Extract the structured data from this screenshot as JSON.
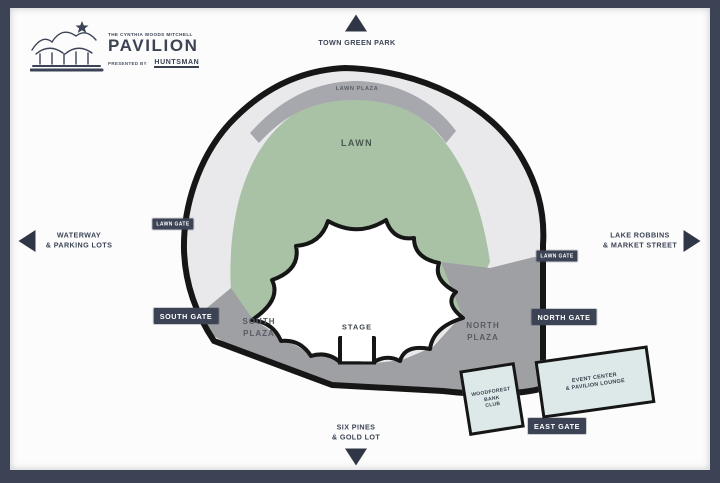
{
  "colors": {
    "frame": "#3b4354",
    "badge": "#3b4354",
    "arrow": "#2f3645",
    "outline": "#161616",
    "concourse_ring": "#e9e9ec",
    "lawn": "#a9c2a6",
    "lawn_plaza_band": "#a7a8ad",
    "plaza": "#9fa0a4",
    "building": "#dde8e8",
    "bowl": "#ffffff"
  },
  "logo": {
    "venue_small": "THE CYNTHIA WOODS MITCHELL",
    "venue_name": "PAVILION",
    "presented_by": "PRESENTED BY",
    "sponsor": "HUNTSMAN"
  },
  "directions": {
    "north": "TOWN GREEN PARK",
    "west": [
      "WATERWAY",
      "& PARKING LOTS"
    ],
    "east": [
      "LAKE ROBBINS",
      "& MARKET STREET"
    ],
    "south": [
      "SIX PINES",
      "& GOLD LOT"
    ]
  },
  "map": {
    "lawn_plaza": "LAWN PLAZA",
    "lawn": "LAWN",
    "south_plaza": [
      "SOUTH",
      "PLAZA"
    ],
    "north_plaza": [
      "NORTH",
      "PLAZA"
    ],
    "stage": "STAGE",
    "gates": {
      "lawn_gate_west": "LAWN GATE",
      "lawn_gate_east": "LAWN GATE",
      "south_gate": "SOUTH GATE",
      "north_gate": "NORTH GATE",
      "east_gate": "EAST GATE"
    },
    "buildings": {
      "woodforest": [
        "WOODFOREST",
        "BANK",
        "CLUB"
      ],
      "event_center": [
        "EVENT CENTER",
        "& PAVILION LOUNGE"
      ]
    }
  }
}
